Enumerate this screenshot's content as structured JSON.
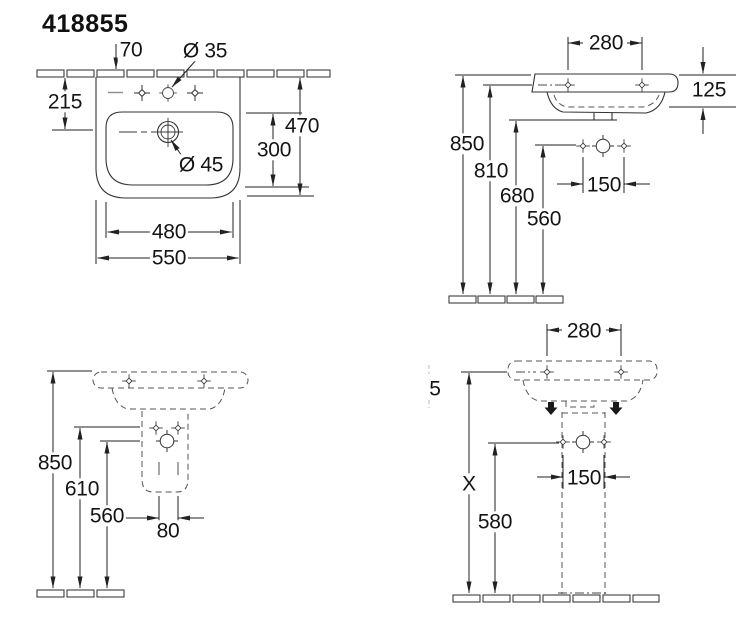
{
  "title": "418855",
  "views": {
    "top_view": {
      "name": "basin top view",
      "dims": {
        "wall_offset": "70",
        "faucet_hole_dia": "Ø 35",
        "left_depth": "215",
        "overall_depth": "470",
        "inner_depth": "300",
        "drain_dia": "Ø 45",
        "inner_width": "480",
        "overall_width": "550"
      }
    },
    "front_elevation": {
      "name": "wall-hung front elevation",
      "dims": {
        "tap_hole_spacing": "280",
        "rim_thickness": "125",
        "rim_height": "850",
        "fixing_height": "810",
        "drain_height": "680",
        "supply_height": "560",
        "supply_spacing": "150"
      }
    },
    "side_elevation": {
      "name": "side elevation",
      "dims": {
        "rim_height": "850",
        "fixing_height": "610",
        "supply_height": "560",
        "drain_width": "80"
      }
    },
    "pedestal_view": {
      "name": "pedestal installation view",
      "dims": {
        "tap_hole_spacing": "280",
        "cropped_label": "5",
        "height_x": "X",
        "supply_height": "580",
        "supply_spacing": "150"
      }
    }
  },
  "colors": {
    "line": "#333333",
    "dash": "#555555",
    "text": "#141414",
    "background": "#ffffff"
  }
}
